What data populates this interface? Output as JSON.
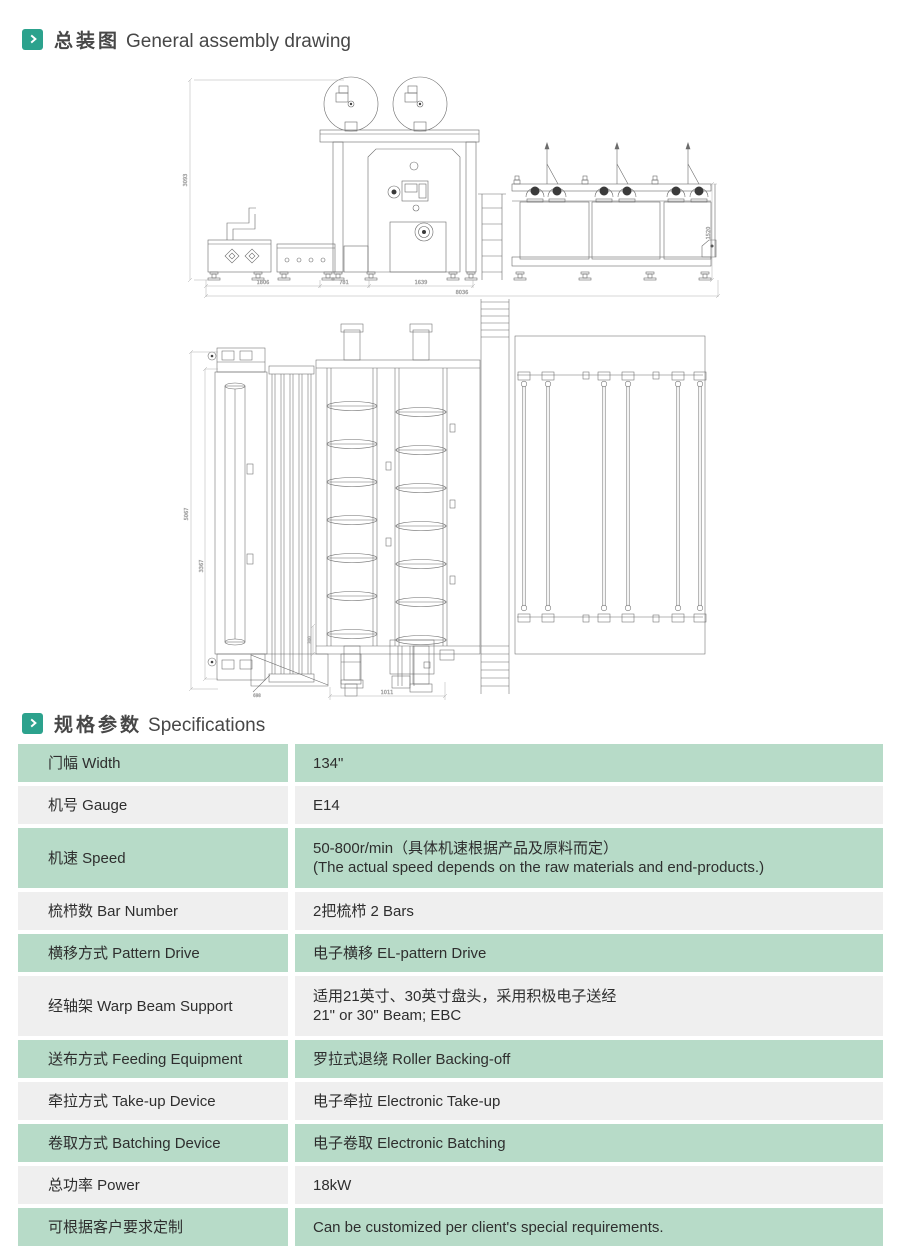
{
  "accent": "#2ca28d",
  "section1": {
    "title_zh": "总装图",
    "title_en": "General assembly drawing"
  },
  "section2": {
    "title_zh": "规格参数",
    "title_en": "Specifications"
  },
  "drawing": {
    "view1": {
      "height": "3093",
      "creel_height": "1520",
      "seg1": "1806",
      "seg2": "781",
      "seg3": "1639",
      "total": "8036"
    },
    "view2": {
      "depth_outer": "5067",
      "depth_inner": "3367",
      "offset": "300",
      "front": "1011",
      "note": "698"
    }
  },
  "spec_table": {
    "rows": [
      {
        "label": "门幅 Width",
        "value": "134\""
      },
      {
        "label": "机号 Gauge",
        "value": "E14"
      },
      {
        "label": "机速 Speed",
        "value": "50-800r/min（具体机速根据产品及原料而定）",
        "value2": "(The actual speed depends on the raw materials and end-products.)"
      },
      {
        "label": "梳栉数 Bar Number",
        "value": "2把梳栉  2 Bars"
      },
      {
        "label": "横移方式 Pattern Drive",
        "value": "电子横移 EL-pattern Drive"
      },
      {
        "label": "经轴架 Warp Beam Support",
        "value": "适用21英寸、30英寸盘头，采用积极电子送经",
        "value2": "21\" or 30\" Beam;  EBC"
      },
      {
        "label": "送布方式 Feeding Equipment",
        "value": "罗拉式退绕  Roller Backing-off"
      },
      {
        "label": "牵拉方式 Take-up Device",
        "value": "电子牵拉 Electronic Take-up"
      },
      {
        "label": "卷取方式 Batching Device",
        "value": "电子卷取 Electronic Batching"
      },
      {
        "label": "总功率 Power",
        "value": "18kW"
      },
      {
        "label": "可根据客户要求定制",
        "value": "Can be customized per client's special requirements."
      }
    ]
  },
  "colors": {
    "row_green": "#b7dbc8",
    "row_gray": "#efefef"
  }
}
